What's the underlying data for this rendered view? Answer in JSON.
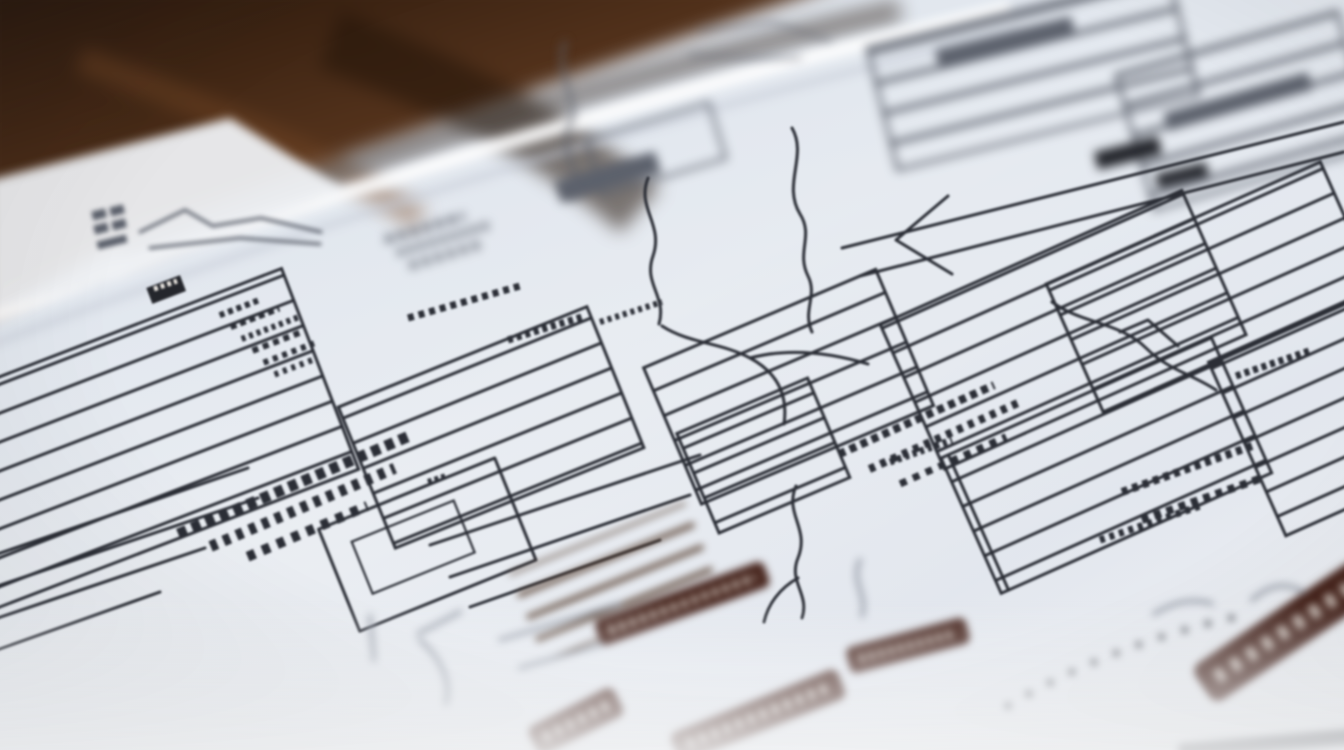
{
  "meta": {
    "type": "photograph",
    "subject": "Macro photo of printed flowchart and diagram sheets lying on a dark wooden desk",
    "focus": "Shallow depth of field: sharp band across the middle of the page, heavy blur on the wooden desk (top-left) and on the foreground paper (bottom)",
    "legible_text": "none — all printed text is illegible pseudo-text at this distance/angle",
    "orientation": "diagram artwork rotated roughly -20 degrees (rising toward upper right)"
  },
  "palette": {
    "wood1": "#23140a",
    "wood2": "#50301a",
    "wood3": "#7b4a28",
    "paper": "#f0f2f5",
    "paper2": "#e3e7ee",
    "paper-cool": "#dce3ec",
    "shadow": "#c3c9d4",
    "ink": "#2b2e36",
    "ink-soft": "#5c616c",
    "ink-faint": "#979da8",
    "ink-warm": "#5a4334",
    "maroon": "#46241c",
    "chip": "#24262c",
    "labeltxt": "#d8cfc8",
    "dot": "#3c3f46"
  },
  "scene": {
    "background": "blurred dark-brown wooden desktop in top-left corner",
    "sheets": [
      "main white diagram sheet filling the frame",
      "corner of a second sheet overlapping the desk at left",
      "edge highlight of an underlying sheet running diagonally near the top"
    ],
    "elements": [
      {
        "name": "left-list-box",
        "description": "tall outlined box with horizontal rule lines and a small dark header chip, tiny label column beside it"
      },
      {
        "name": "left-pseudo-text",
        "description": "two rows of large illegible printed words rotated with the page"
      },
      {
        "name": "center-flow-connectors",
        "description": "hand-drawn-looking squiggly branch lines linking boxes"
      },
      {
        "name": "center-striped-boxes",
        "description": "outlined boxes filled with parallel rule lines"
      },
      {
        "name": "right-striped-panels",
        "description": "dense parallel-line table panels running off the right edge with small vertical pseudo-text"
      },
      {
        "name": "top-right-blurred-structures",
        "description": "out-of-focus gray boxes and dark bars on the far part of the sheet"
      },
      {
        "name": "maroon-label-bars",
        "description": "six blurred dark red-brown rounded label bars with illegible light text in the foreground"
      },
      {
        "name": "dotted-arc",
        "description": "dotted curved leader line near the bottom right"
      },
      {
        "name": "mini-grid-sketch",
        "description": "tiny blurred grid sketch on the overlapping sheet corner at far left"
      }
    ]
  }
}
